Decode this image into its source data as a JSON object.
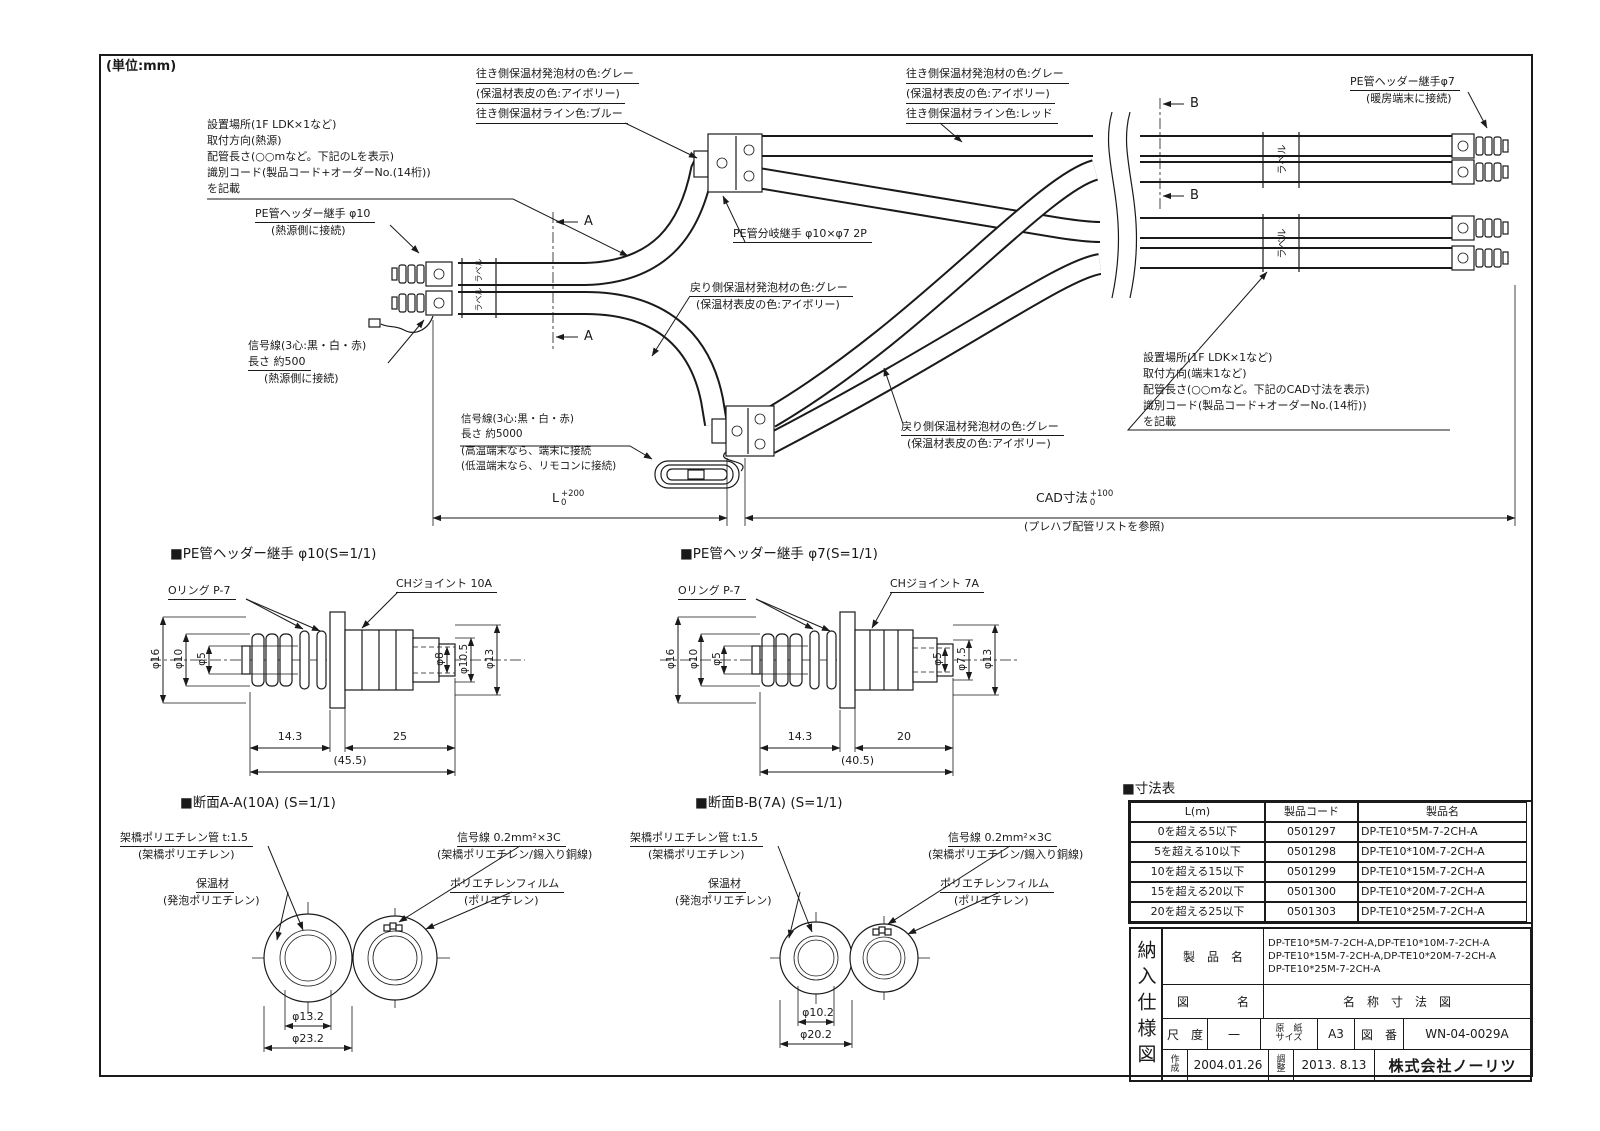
{
  "unit_note": "(単位:mm)",
  "assembly": {
    "note_heat_source": [
      "設置場所(1F LDK×1など)",
      "取付方向(熱源)",
      "配管長さ(○○mなど。下記のLを表示)",
      "識別コード(製品コード+オーダーNo.(14桁))",
      "を記載"
    ],
    "note_terminal": [
      "設置場所(1F LDK×1など)",
      "取付方向(端末1など)",
      "配管長さ(○○mなど。下記のCAD寸法を表示)",
      "識別コード(製品コード+オーダーNo.(14桁))",
      "を記載"
    ],
    "pe_header_10": [
      "PE管ヘッダー継手 φ10",
      "(熱源側に接続)"
    ],
    "pe_header_7": [
      "PE管ヘッダー継手φ7",
      "(暖房端末に接続)"
    ],
    "pe_branch": "PE管分岐継手 φ10×φ7 2P",
    "signal_short": [
      "信号線(3心:黒・白・赤)",
      "長さ 約500",
      "(熱源側に接続)"
    ],
    "signal_long": [
      "信号線(3心:黒・白・赤)",
      "長さ 約5000",
      "(高温端末なら、端末に接続",
      "(低温端末なら、リモコンに接続)"
    ],
    "outward_blue": [
      "往き側保温材発泡材の色:グレー",
      "(保温材表皮の色:アイボリー)",
      "往き側保温材ライン色:ブルー"
    ],
    "outward_red": [
      "往き側保温材発泡材の色:グレー",
      "(保温材表皮の色:アイボリー)",
      "往き側保温材ライン色:レッド"
    ],
    "return_gray_1": [
      "戻り側保温材発泡材の色:グレー",
      "(保温材表皮の色:アイボリー)"
    ],
    "return_gray_2": [
      "戻り側保温材発泡材の色:グレー",
      "(保温材表皮の色:アイボリー)"
    ],
    "label_tape": "ラベル",
    "section_a": "A",
    "section_b": "B",
    "dim_l": {
      "base": "L",
      "upper": "+200",
      "lower": "0"
    },
    "dim_cad": {
      "base": "CAD寸法",
      "upper": "+100",
      "lower": "0"
    },
    "cad_note": "(プレハブ配管リストを参照)"
  },
  "fitting10": {
    "title": "■PE管ヘッダー継手 φ10(S=1/1)",
    "oring": "Oリング P-7",
    "joint": "CHジョイント 10A",
    "d16": "φ16",
    "d10": "φ10",
    "d5": "φ5",
    "d8": "φ8",
    "d105": "φ10.5",
    "d13": "φ13",
    "len1": "14.3",
    "len2": "25",
    "len_total": "(45.5)"
  },
  "fitting7": {
    "title": "■PE管ヘッダー継手 φ7(S=1/1)",
    "oring": "Oリング P-7",
    "joint": "CHジョイント 7A",
    "d16": "φ16",
    "d10": "φ10",
    "d5l": "φ5",
    "d5r": "φ5",
    "d75": "φ7.5",
    "d13": "φ13",
    "len1": "14.3",
    "len2": "20",
    "len_total": "(40.5)"
  },
  "section_a": {
    "title": "■断面A-A(10A) (S=1/1)",
    "pex": [
      "架橋ポリエチレン管 t:1.5",
      "(架橋ポリエチレン)"
    ],
    "insulation": [
      "保温材",
      "(発泡ポリエチレン)"
    ],
    "signal": [
      "信号線 0.2mm²×3C",
      "(架橋ポリエチレン/錫入り銅線)"
    ],
    "film": [
      "ポリエチレンフィルム",
      "(ポリエチレン)"
    ],
    "dia_inner": "φ13.2",
    "dia_outer": "φ23.2"
  },
  "section_b": {
    "title": "■断面B-B(7A) (S=1/1)",
    "pex": [
      "架橋ポリエチレン管 t:1.5",
      "(架橋ポリエチレン)"
    ],
    "insulation": [
      "保温材",
      "(発泡ポリエチレン)"
    ],
    "signal": [
      "信号線 0.2mm²×3C",
      "(架橋ポリエチレン/錫入り銅線)"
    ],
    "film": [
      "ポリエチレンフィルム",
      "(ポリエチレン)"
    ],
    "dia_inner": "φ10.2",
    "dia_outer": "φ20.2"
  },
  "size_table": {
    "title": "■寸法表",
    "headers": [
      "L(m)",
      "製品コード",
      "製品名"
    ],
    "rows": [
      [
        "0を超える5以下",
        "0501297",
        "DP-TE10*5M-7-2CH-A"
      ],
      [
        "5を超える10以下",
        "0501298",
        "DP-TE10*10M-7-2CH-A"
      ],
      [
        "10を超える15以下",
        "0501299",
        "DP-TE10*15M-7-2CH-A"
      ],
      [
        "15を超える20以下",
        "0501300",
        "DP-TE10*20M-7-2CH-A"
      ],
      [
        "20を超える25以下",
        "0501303",
        "DP-TE10*25M-7-2CH-A"
      ]
    ]
  },
  "title_block": {
    "doc_type_vertical": "納入仕様図",
    "product_label": "製　品　名",
    "product_names": [
      "DP-TE10*5M-7-2CH-A,DP-TE10*10M-7-2CH-A",
      "DP-TE10*15M-7-2CH-A,DP-TE10*20M-7-2CH-A",
      "DP-TE10*25M-7-2CH-A"
    ],
    "drawing_label": "図　　　　名",
    "drawing_name": "名　称　寸　法　図",
    "scale_label": "尺　度",
    "scale_value": "一",
    "paper_label": [
      "原　紙",
      "サイズ"
    ],
    "paper_value": "A3",
    "number_label": "図　番",
    "number_value": "WN-04-0029A",
    "created_label": [
      "作",
      "成"
    ],
    "created_date": "2004.01.26",
    "adjusted_label": [
      "調",
      "整"
    ],
    "adjusted_date": "2013. 8.13",
    "company": "株式会社ノーリツ"
  }
}
